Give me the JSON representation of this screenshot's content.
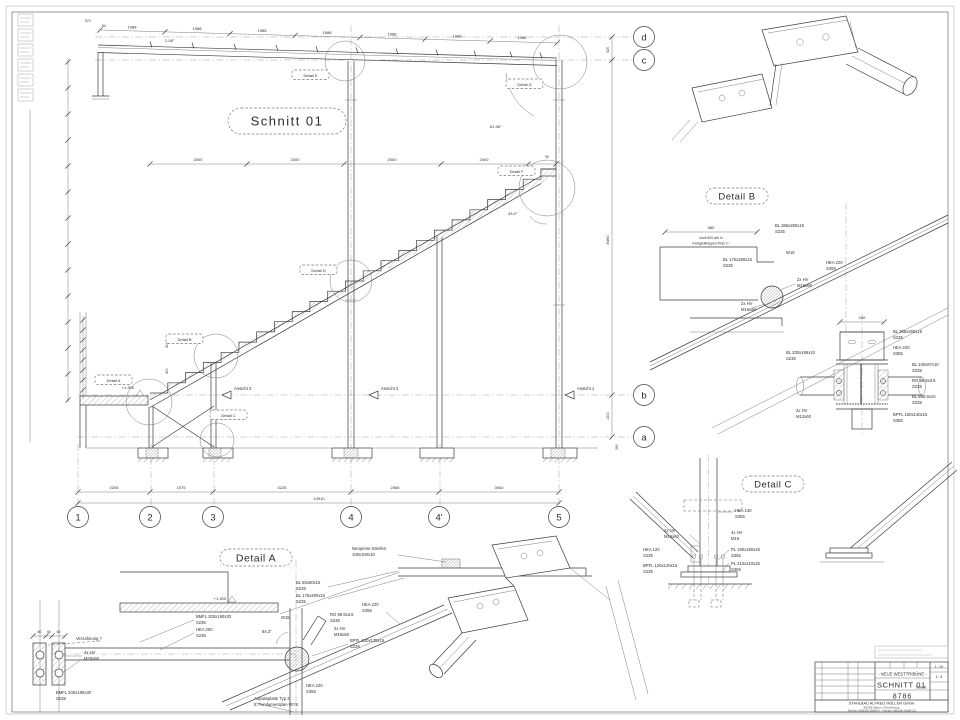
{
  "section": {
    "title": "Schnitt 01",
    "angles": {
      "roof": "2.08°",
      "stair": "43.4°",
      "brace": "61.56°"
    },
    "dims": {
      "top_run": "1988",
      "top_a": "570",
      "top_b": "84",
      "mid": [
        "2000",
        "2000",
        "2000",
        "2400",
        "90"
      ],
      "bottom": [
        "2205",
        "1975",
        "4225",
        "2565",
        "3940"
      ],
      "total": "14910",
      "right_dc": "525",
      "right_h": "8460",
      "right_ba": "1300",
      "right_a": "290",
      "stair_r": "400",
      "elevation": "+1.300"
    },
    "grid_cols": [
      "1",
      "2",
      "3",
      "4",
      "4'",
      "5"
    ],
    "grid_rows": [
      "d",
      "c",
      "b",
      "a"
    ],
    "callouts": [
      "Detail E",
      "Detail G",
      "Detail F",
      "Detail D",
      "Detail B",
      "Detail A",
      "Detail C"
    ],
    "views": [
      "Ansicht 3",
      "Ansicht 2",
      "Ansicht 1"
    ]
  },
  "detail_b": {
    "title": "Detail B",
    "dim_width": "580",
    "dim_240": "240",
    "note_line1": "nicht 600 wie in",
    "note_line2": "Fertigteiltreppen-Plan 2 !",
    "labels": [
      [
        "BL 366x280x15",
        "S235"
      ],
      [
        "BL 175x280x15",
        "S235"
      ],
      [
        "W16",
        ""
      ],
      [
        "2x HV",
        "M16x65"
      ],
      [
        "2x HV",
        "M16x60"
      ],
      [
        "HEA 220",
        "S355"
      ],
      [
        "BL 366x280x15",
        "S235"
      ],
      [
        "HEA 220",
        "S355"
      ],
      [
        "BL 100x87x10",
        "S235"
      ],
      [
        "RO 88.9x3.6",
        "S235"
      ],
      [
        "BL ø88.9x10",
        "S235"
      ],
      [
        "2x HV",
        "M12x60"
      ],
      [
        "BPFL 150x140x15",
        "S355"
      ],
      [
        "BL 200x196x10",
        "S235"
      ]
    ]
  },
  "detail_c": {
    "title": "Detail C",
    "labels": [
      [
        "HEA 140",
        "S355"
      ],
      [
        "2x HV",
        "M16x60"
      ],
      [
        "4x HV",
        "M16"
      ],
      [
        "HEA 120",
        "S235"
      ],
      [
        "BPFL 120x120x15",
        "S235"
      ],
      [
        "PL 180x180x25",
        "S355"
      ],
      [
        "PL 210x210x25",
        "S355"
      ]
    ]
  },
  "detail_a": {
    "title": "Detail A",
    "dim_60": "60",
    "elevation": "+1.300",
    "labels": [
      [
        "Neoprene-Streifen",
        "100x100x10"
      ],
      [
        "BL 80x80x15",
        "S235"
      ],
      [
        "BL 175x280x15",
        "S235"
      ],
      [
        "BMFL 200x190x30",
        "S235"
      ],
      [
        "HEA 200",
        "S235"
      ],
      [
        "W15",
        ""
      ],
      [
        "84.3°",
        ""
      ],
      [
        "RO 88.9x3.6",
        "S235"
      ],
      [
        "2x HV",
        "M16x60"
      ],
      [
        "HEA 220",
        "S355"
      ],
      [
        "BPFL 120x135x15",
        "S235"
      ],
      [
        "Verzahnung ?",
        ""
      ],
      [
        "4x HV",
        "M20x80"
      ],
      [
        "BMFL 200x190x30",
        "S235"
      ],
      [
        "Anpassplatte Typ 2",
        "lt. Fundamentplan 0076"
      ]
    ]
  },
  "title_block": {
    "project": "- NEUE WESTTRIBÜNE -",
    "drawing_title": "SCHNITT 01",
    "subtitle": "Details",
    "drawing_number": "8786",
    "scale_1": "1 : 20",
    "scale_2": "1 : 5",
    "company": "STAHLBAU ALFRED MÜLLER GmbH",
    "address": "89296 Mauer / Riedelberg",
    "phone": "Telefon (08236) 8208-0 · Telefax (08236) 8208-10"
  }
}
